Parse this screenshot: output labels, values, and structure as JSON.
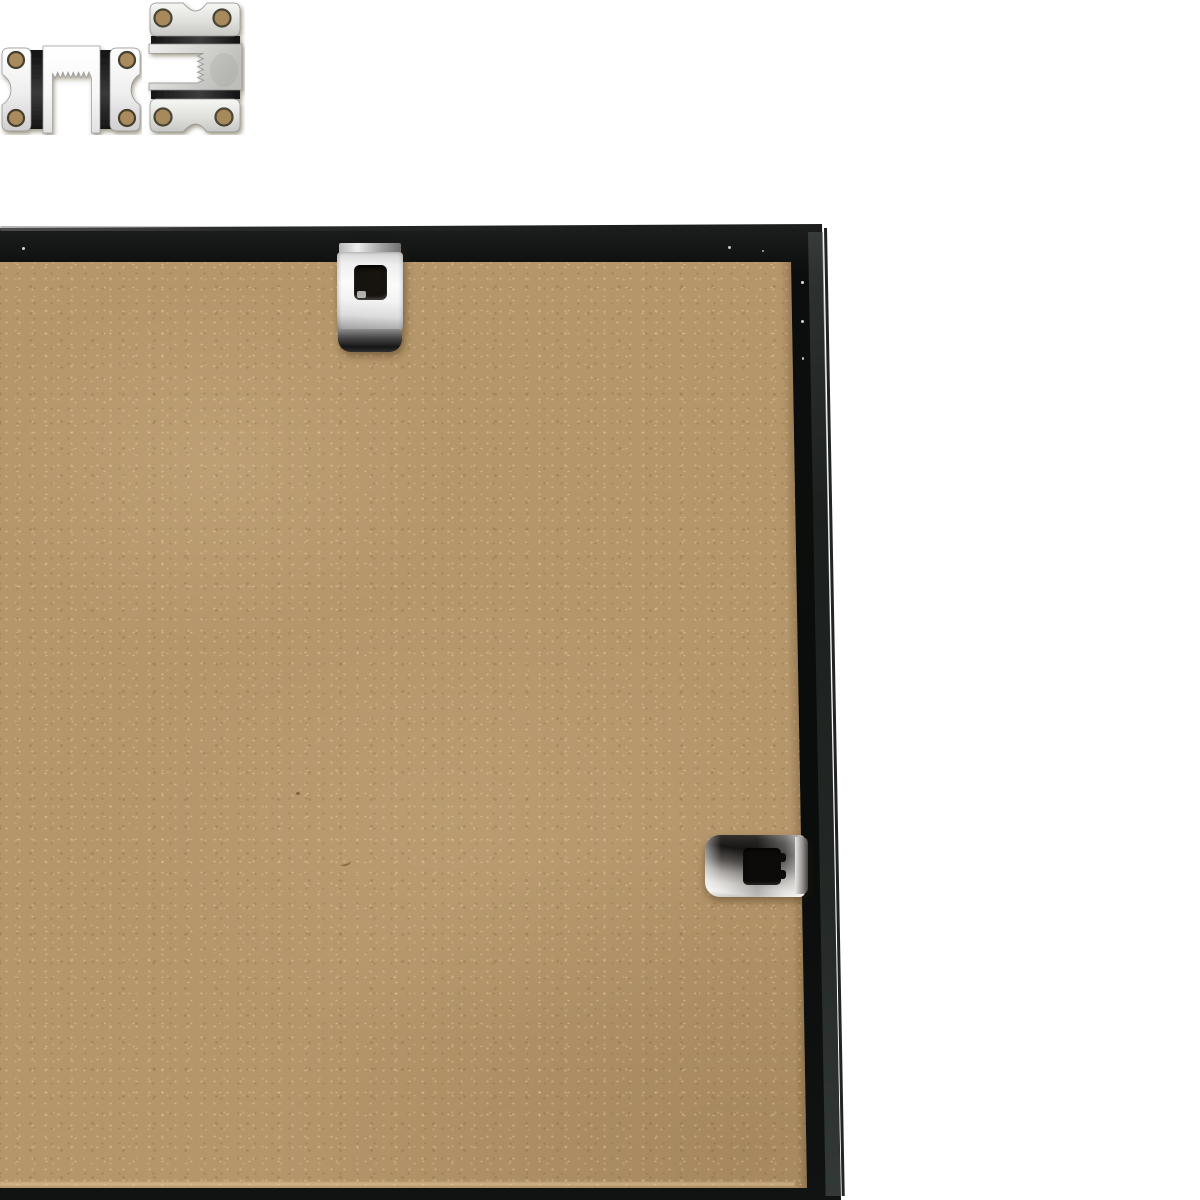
{
  "scene": {
    "description": "Close-up photo of the back of a black picture frame: tan MDF backing board, black metal frame edges on a white background, with silver mounting hardware",
    "colors": {
      "background": "#ffffff",
      "board": "#b5956a",
      "board-light": "#cdb284",
      "board-dark": "#96784e",
      "frame-black": "#0c0e0d",
      "frame-edge-sheen": "#3a423e",
      "metal-bright": "#f6f6f5",
      "metal-mid": "#c9c9c6",
      "metal-dark": "#2a2a28",
      "hole-dark": "#17130e"
    },
    "objects": [
      {
        "name": "mdf-backing-board",
        "label": "MDF backing board"
      },
      {
        "name": "frame-top-edge",
        "label": "Black frame top edge"
      },
      {
        "name": "frame-right-edge",
        "label": "Black frame right edge"
      },
      {
        "name": "frame-bottom-edge",
        "label": "Black frame bottom edge"
      },
      {
        "name": "top-retainer-clip",
        "label": "Metal retainer clip on top edge"
      },
      {
        "name": "sawtooth-hanger-top",
        "label": "Sawtooth hanger plate, upper, opening down"
      },
      {
        "name": "sawtooth-hanger-bottom",
        "label": "Sawtooth hanger plate, lower, rotated, opening left"
      },
      {
        "name": "right-retainer-clip",
        "label": "Metal retainer clip on right edge"
      },
      {
        "name": "left-retainer-clip-partial",
        "label": "Partially visible metal clip at left edge"
      }
    ]
  }
}
